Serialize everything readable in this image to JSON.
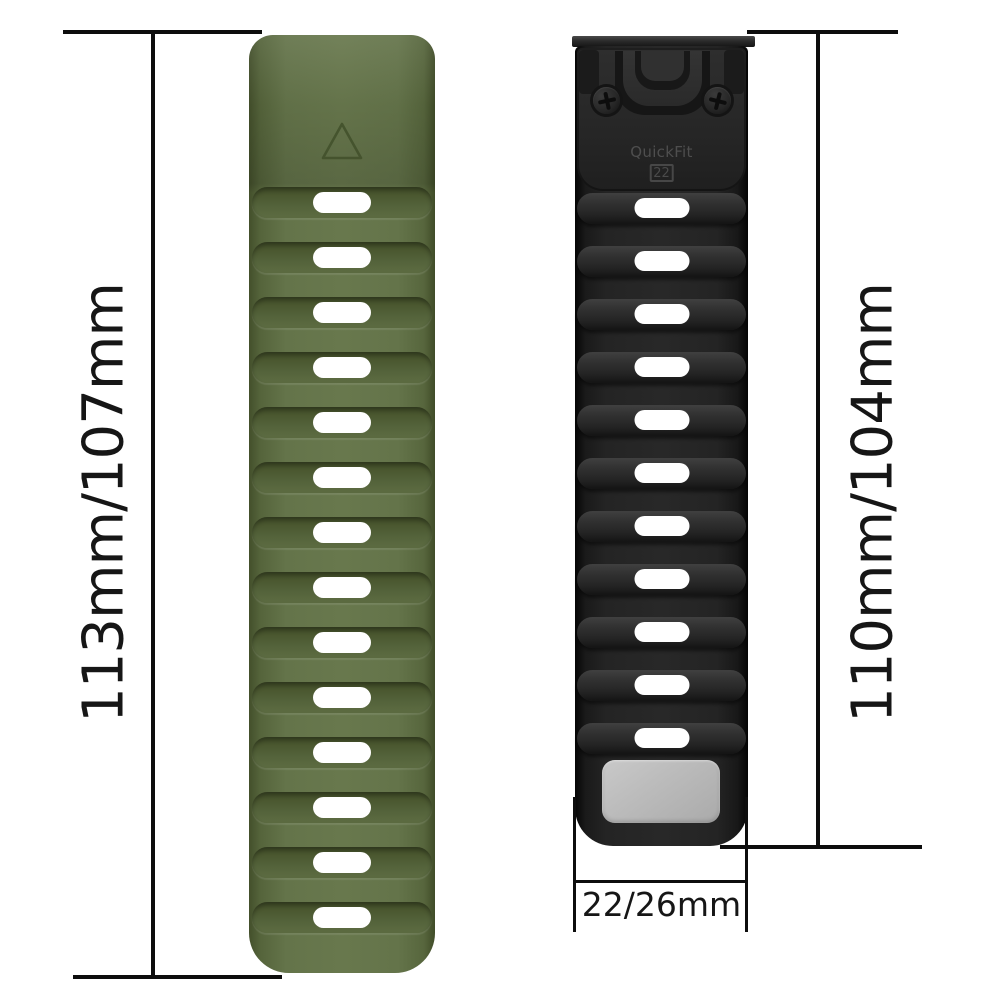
{
  "meta": {
    "description": "Watch strap size diagram with two silicone quick-release bands and dimension annotations",
    "background": "#ffffff",
    "dimension_line_color": "#0d0d0d",
    "dimension_text_color": "#161616"
  },
  "left_band": {
    "name": "army-green silicone strap",
    "length_label": "113mm/107mm",
    "slot_count": 14,
    "base_color": "#5d6c42",
    "shadow_color": "#47542f",
    "slot_color": "#ffffff",
    "logo": "triangle-outline"
  },
  "right_band": {
    "name": "black silicone strap with QuickFit connector",
    "length_label": "110mm/104mm",
    "slot_count": 11,
    "base_color": "#232323",
    "ridge_color": "#323232",
    "slot_color": "#ffffff",
    "connector": {
      "brand": "QuickFit",
      "size": "22",
      "text_color": "#4e4e4e"
    },
    "keeper_patch_color": "#b9b9b9",
    "width_label": "22/26mm"
  }
}
